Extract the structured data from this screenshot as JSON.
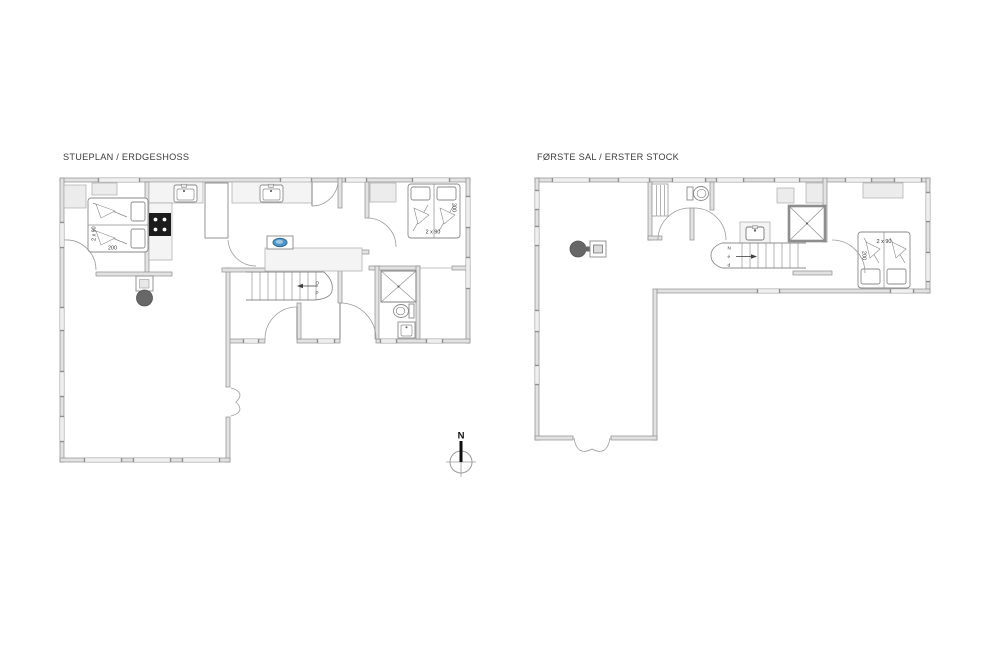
{
  "page": {
    "background": "#ffffff"
  },
  "floor_plans": {
    "ground_floor": {
      "title": "STUEPLAN / ERDGESHOSS",
      "bedroom_left": {
        "width_label": "2 x 90",
        "length_label": "200"
      },
      "bedroom_right": {
        "width_label": "2 x 90",
        "length_label": "200"
      },
      "stairs_label": {
        "char1": "O",
        "char2": "P"
      }
    },
    "first_floor": {
      "title": "FØRSTE SAL / ERSTER STOCK",
      "bedroom": {
        "width_label": "2 x 90",
        "length_label": "200"
      },
      "stairs_label": {
        "char1": "N",
        "char2": "e",
        "char3": "d"
      }
    }
  },
  "compass": {
    "north_label": "N"
  },
  "fixtures": [
    "double-bed",
    "wardrobe",
    "cooktop",
    "kitchen-sink",
    "island-sink",
    "wood-stove",
    "staircase",
    "shower",
    "toilet",
    "washbasin",
    "entrance-door",
    "french-door",
    "double-door",
    "window"
  ],
  "colors": {
    "wall_fill": "#e2e2e2",
    "wall_stroke": "#8d8d8d",
    "closet_fill": "#ececec",
    "counter_fill": "#f4f4f4",
    "cooktop_fill": "#1c1c1c",
    "sink_basin_blue": "#4e96c8",
    "wood_stove_fill": "#676767",
    "text_color": "#3d3d3d"
  }
}
